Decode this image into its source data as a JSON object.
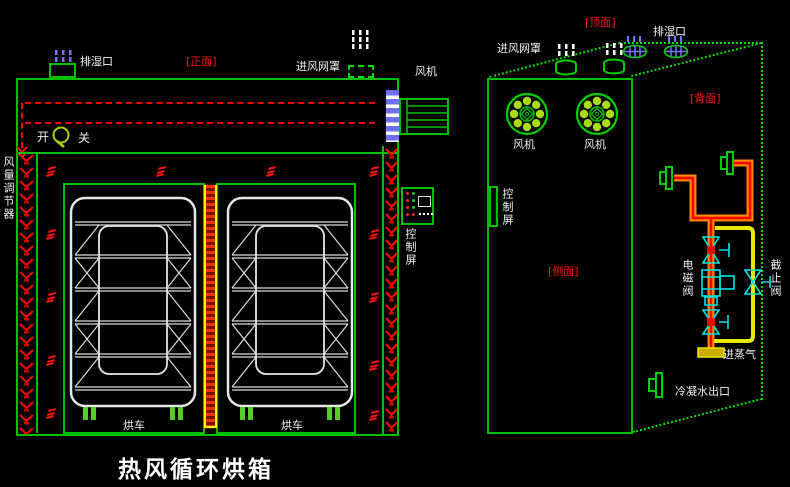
{
  "title": "热风循环烘箱",
  "colors": {
    "line_green": "#00c000",
    "bright_green": "#00dd00",
    "red": "#ff0000",
    "blue": "#7070ff",
    "cyan": "#00e0e0",
    "yellow": "#e8e800",
    "orange": "#ff8800",
    "white": "#f2f2f2"
  },
  "front_view": {
    "view_label": "[正面]",
    "exhaust_port_label": "排湿口",
    "inlet_mesh_label": "进风网罩",
    "fan_label": "风机",
    "switch_on_label": "开",
    "switch_off_label": "关",
    "air_regulator_label": "风量调节器",
    "control_panel_label": "控制屏",
    "cart_label": "烘车"
  },
  "side_view": {
    "top_face_label": "[顶面]",
    "back_face_label": "[背面]",
    "side_face_label": "[侧面]",
    "exhaust_port_label": "排湿口",
    "inlet_mesh_label": "进风网罩",
    "fan_label": "风机",
    "control_panel_label": "控制屏",
    "solenoid_valve_label": "电磁阀",
    "stop_valve_label": "截止阀",
    "steam_inlet_label": "进蒸气",
    "condensate_outlet_label": "冷凝水出口"
  }
}
